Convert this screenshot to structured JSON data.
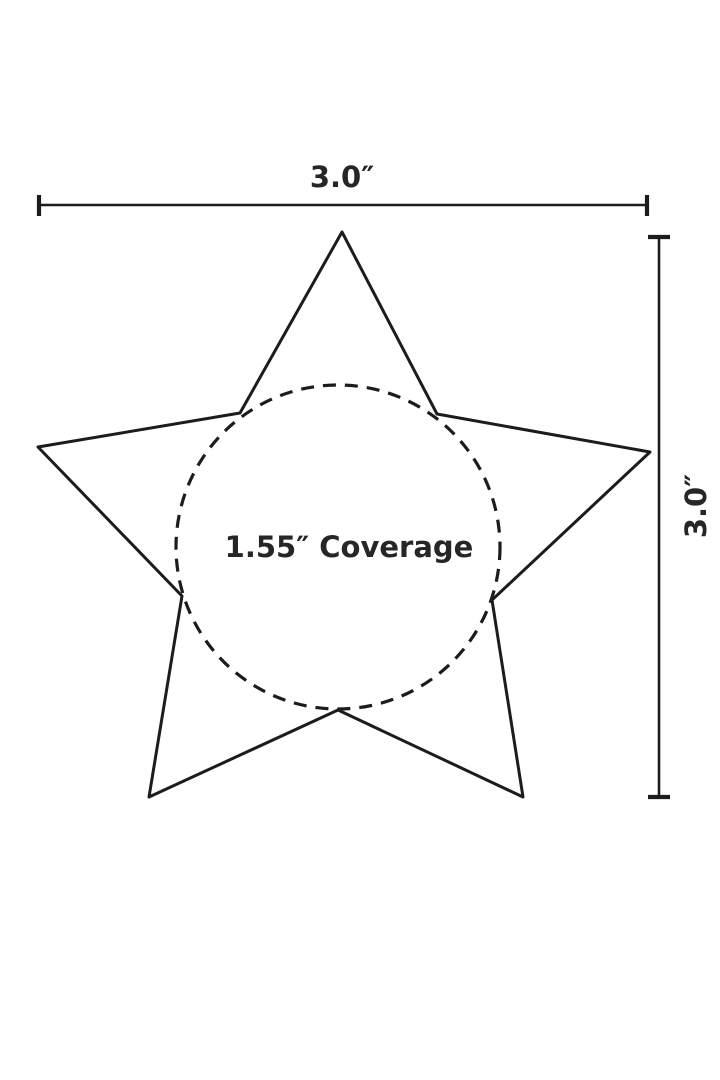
{
  "diagram": {
    "labels": {
      "width": "3.0″",
      "height": "3.0″",
      "coverage": "1.55″ Coverage"
    },
    "colors": {
      "line": "#1c1c1c",
      "text": "#262626",
      "background": "#ffffff"
    }
  }
}
